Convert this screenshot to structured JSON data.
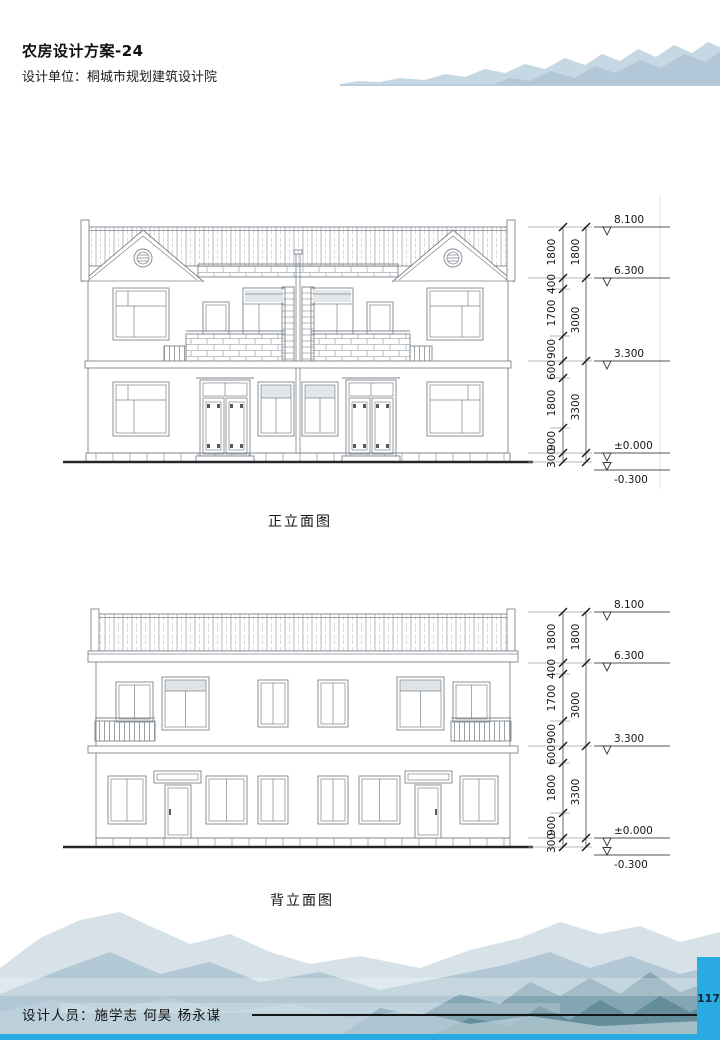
{
  "header": {
    "title": "农房设计方案-24",
    "design_unit": "设计单位：桐城市规划建筑设计院"
  },
  "drawings": [
    {
      "caption": "正立面图",
      "levels": [
        "8.100",
        "6.300",
        "3.300",
        "±0.000",
        "-0.300"
      ],
      "dims_inner": [
        "1800",
        "400",
        "1700",
        "900",
        "600",
        "1800",
        "900",
        "300"
      ],
      "dims_outer": [
        "1800",
        "3000",
        "3300"
      ]
    },
    {
      "caption": "背立面图",
      "levels": [
        "8.100",
        "6.300",
        "3.300",
        "±0.000",
        "-0.300"
      ],
      "dims_inner": [
        "1800",
        "400",
        "1700",
        "900",
        "600",
        "1800",
        "900",
        "300"
      ],
      "dims_outer": [
        "1800",
        "3000",
        "3300"
      ]
    }
  ],
  "footer": {
    "designers": "设计人员：施学志  何昊  杨永谋",
    "page_number": "117"
  },
  "colors": {
    "accent_blue": "#29abe2",
    "drawing_line": "#7e858c",
    "dim_text": "#161616"
  }
}
